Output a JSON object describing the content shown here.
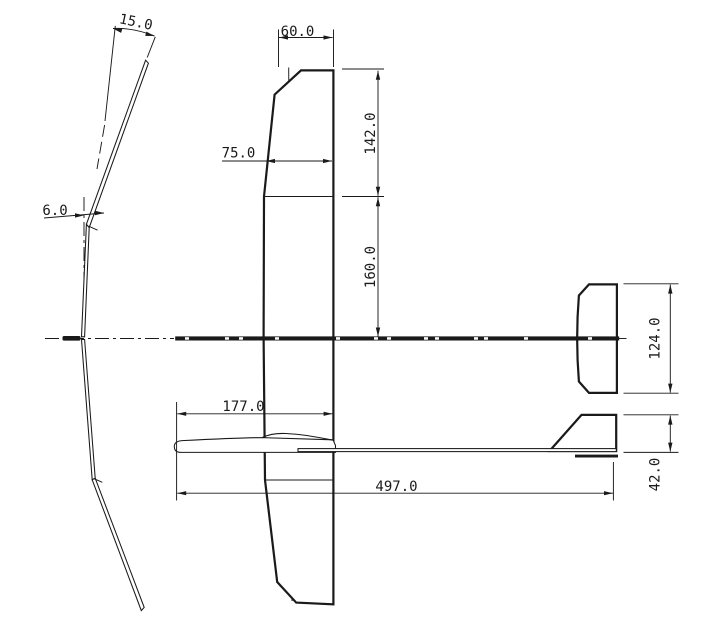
{
  "drawing": {
    "title": "Model glider three-view technical drawing",
    "background_color": "#ffffff",
    "line_color": "#1a1a1a",
    "dimensions": {
      "tip_dihedral_angle": "15.0",
      "inner_dihedral_angle": "6.0",
      "wing_tip_chord": "60.0",
      "wing_root_chord": "75.0",
      "outer_panel_span": "142.0",
      "inner_panel_span": "160.0",
      "nose_to_wing_trailing_edge": "177.0",
      "overall_length": "497.0",
      "stabilizer_span": "124.0",
      "fin_height": "42.0"
    }
  }
}
